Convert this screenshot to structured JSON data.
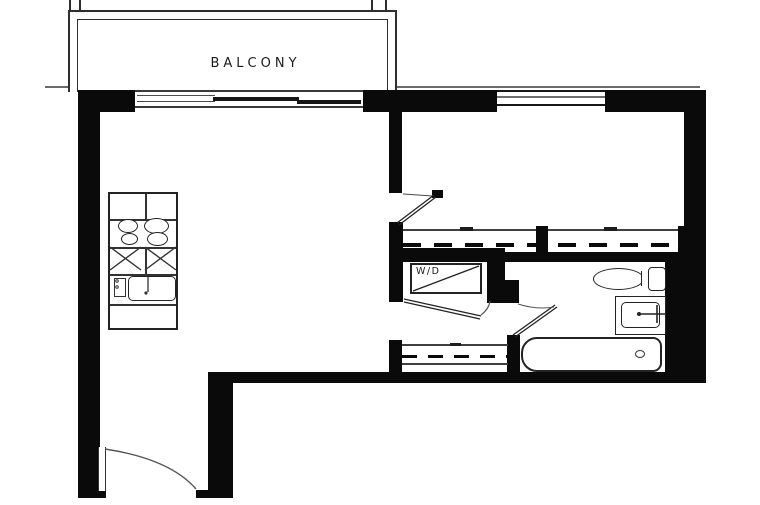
{
  "plan": {
    "labels": {
      "balcony": "BALCONY",
      "washer_dryer": "W/D"
    },
    "colors": {
      "wall": "#0a0a0a",
      "line": "#3f3f3f",
      "background": "#ffffff",
      "text": "#1c1c1c"
    },
    "fixtures": [
      "balcony",
      "sliding-glass-door",
      "bedroom-window",
      "kitchen-counter",
      "cooktop-burners",
      "kitchen-sink",
      "washer-dryer-closet",
      "bedroom-closet",
      "linen-closet",
      "toilet",
      "vanity-sink",
      "bathtub",
      "entry-door-swing",
      "bedroom-door-swing",
      "bathroom-door-swing",
      "washer-dryer-door-swing"
    ]
  }
}
